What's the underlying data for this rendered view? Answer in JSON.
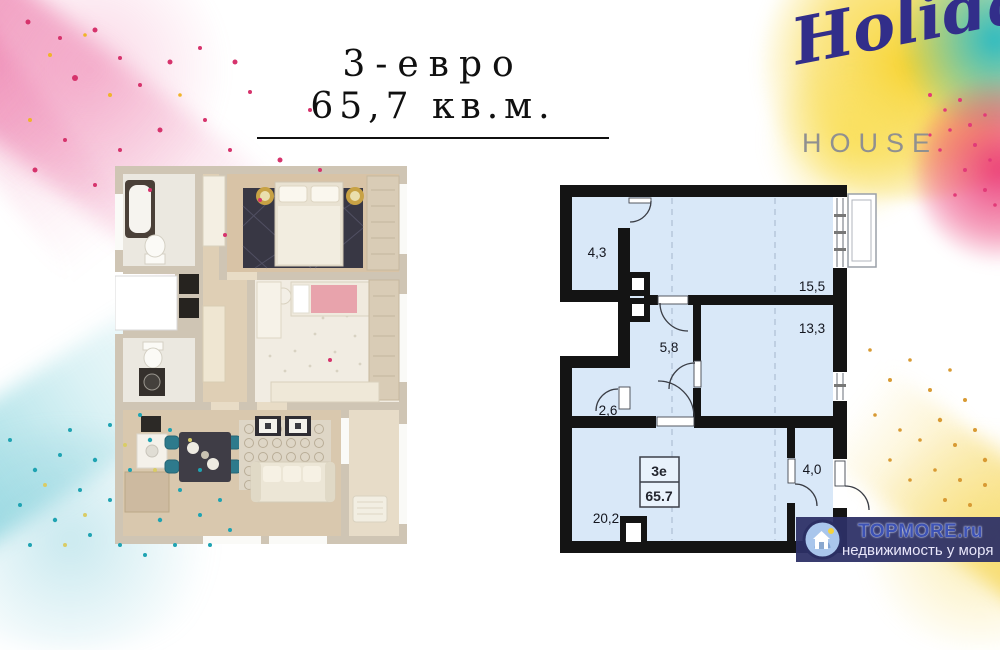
{
  "title": {
    "type_line": "3-евро",
    "area_line": "65,7 кв.м."
  },
  "logo": {
    "name": "Holiday",
    "subtitle": "HOUSE"
  },
  "plan_2d": {
    "room_areas": [
      "4,3",
      "15,5",
      "13,3",
      "5,8",
      "2,6",
      "20,2",
      "4,0"
    ],
    "info_box": {
      "type": "3е",
      "total_area": "65.7"
    }
  },
  "watermark": {
    "site": "TOPMORE.ru",
    "tagline": "недвижимость у моря"
  },
  "colors": {
    "plan_room_fill": "#d9e8f8",
    "plan_wall": "#141414",
    "splash_pink": "#e83e7c",
    "splash_yellow": "#f6d235",
    "splash_teal": "#23b6c6",
    "logo_navy": "#322e8a",
    "watermark_bar": "#2d3066",
    "watermark_site_color": "#3d52b5"
  }
}
